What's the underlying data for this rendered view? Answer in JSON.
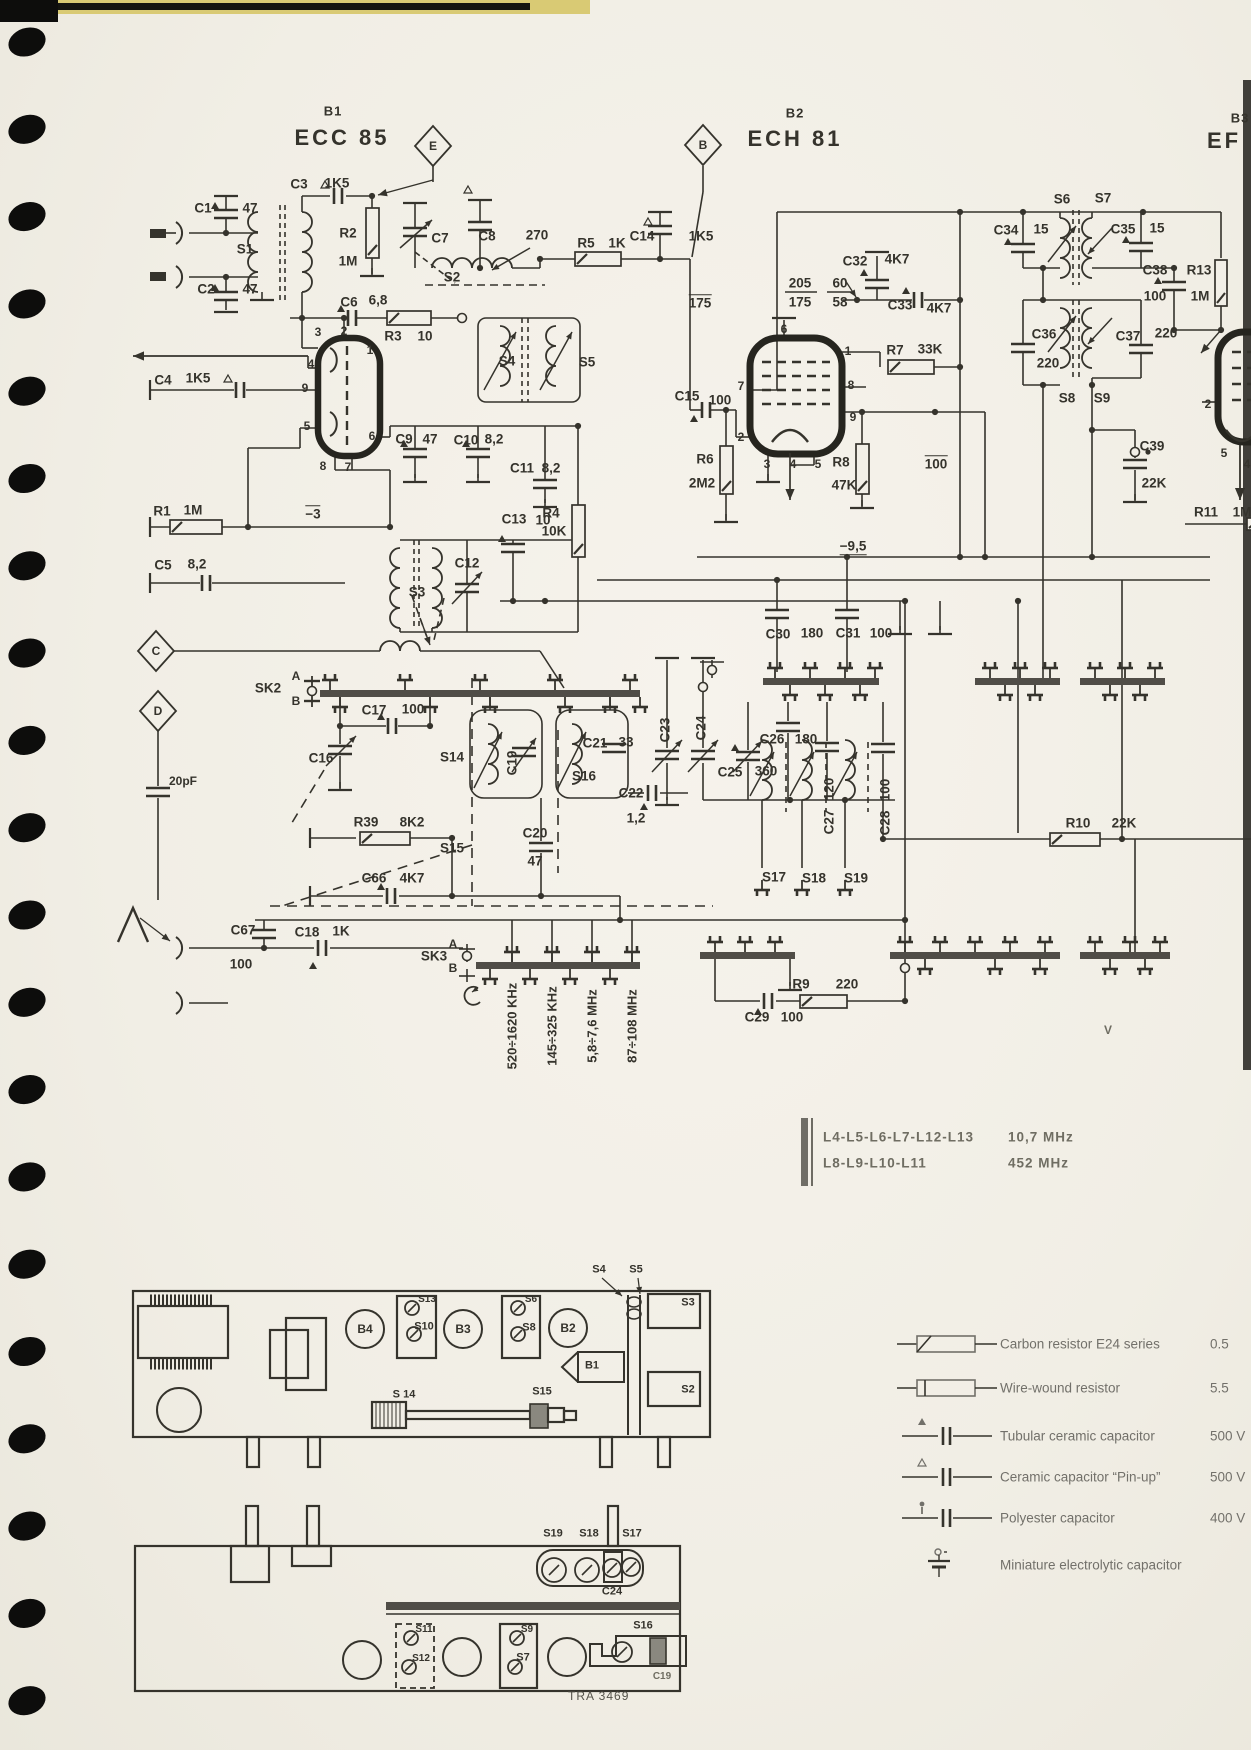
{
  "colors": {
    "paper": "#f2efe7",
    "ink": "#35332c",
    "soft": "#6f6d62",
    "rail": "#504d47",
    "hole": "#0d0d0c",
    "edge": "#413f3a",
    "tape": "#d9ca74"
  },
  "tubes": [
    {
      "ref": "B1",
      "type": "ECC 85"
    },
    {
      "ref": "B2",
      "type": "ECH 81"
    },
    {
      "ref": "B3",
      "type": "EF"
    }
  ],
  "bands": [
    "520÷1620 KHz",
    "145÷325 KHz",
    "5,8÷7,6 MHz",
    "87÷108 MHz"
  ],
  "coil_table": [
    {
      "coils": "L4-L5-L6-L7-L12-L13",
      "freq": "10,7 MHz"
    },
    {
      "coils": "L8-L9-L10-L11",
      "freq": "452 MHz"
    }
  ],
  "legend": [
    {
      "symbol": "carbon-resistor",
      "label": "Carbon resistor E24 series",
      "value": "0.5"
    },
    {
      "symbol": "wire-wound-resistor",
      "label": "Wire-wound resistor",
      "value": "5.5"
    },
    {
      "symbol": "tubular-ceramic-capacitor",
      "label": "Tubular ceramic capacitor",
      "value": "500 V"
    },
    {
      "symbol": "ceramic-capacitor-pinup",
      "label": "Ceramic capacitor “Pin-up”",
      "value": "500 V"
    },
    {
      "symbol": "polyester-capacitor",
      "label": "Polyester capacitor",
      "value": "400 V"
    },
    {
      "symbol": "miniature-electrolytic-capacitor",
      "label": "Miniature electrolytic capacitor",
      "value": ""
    }
  ],
  "footer": {
    "doc_number": "TRA 3469"
  },
  "labels": [
    {
      "n": "tag-e",
      "t": "E",
      "x": 433,
      "y": 146,
      "s": 12
    },
    {
      "n": "tag-b",
      "t": "B",
      "x": 703,
      "y": 145,
      "s": 12
    },
    {
      "n": "tag-c",
      "t": "C",
      "x": 156,
      "y": 651,
      "s": 12
    },
    {
      "n": "tag-d",
      "t": "D",
      "x": 158,
      "y": 711,
      "s": 12
    },
    {
      "n": "c1",
      "t": "C1",
      "x": 203,
      "y": 208
    },
    {
      "n": "c1-v",
      "t": "47",
      "x": 250,
      "y": 208
    },
    {
      "n": "s1",
      "t": "S1",
      "x": 245,
      "y": 249
    },
    {
      "n": "c2",
      "t": "C2",
      "x": 206,
      "y": 289
    },
    {
      "n": "c2-v",
      "t": "47",
      "x": 250,
      "y": 289
    },
    {
      "n": "c3",
      "t": "C3",
      "x": 299,
      "y": 184
    },
    {
      "n": "c3-v",
      "t": "1K5",
      "x": 337,
      "y": 183
    },
    {
      "n": "r2",
      "t": "R2",
      "x": 348,
      "y": 233
    },
    {
      "n": "r2-v",
      "t": "1M",
      "x": 348,
      "y": 261
    },
    {
      "n": "c6",
      "t": "C6",
      "x": 349,
      "y": 302
    },
    {
      "n": "c6-v",
      "t": "6,8",
      "x": 378,
      "y": 300
    },
    {
      "n": "r3",
      "t": "R3",
      "x": 393,
      "y": 336
    },
    {
      "n": "r3-v",
      "t": "10",
      "x": 425,
      "y": 336
    },
    {
      "n": "c7",
      "t": "C7",
      "x": 440,
      "y": 238
    },
    {
      "n": "c8",
      "t": "C8",
      "x": 487,
      "y": 236
    },
    {
      "n": "c8-v",
      "t": "270",
      "x": 537,
      "y": 235
    },
    {
      "n": "s2",
      "t": "S2",
      "x": 452,
      "y": 277
    },
    {
      "n": "r5",
      "t": "R5",
      "x": 586,
      "y": 243
    },
    {
      "n": "r5-v",
      "t": "1K",
      "x": 617,
      "y": 243
    },
    {
      "n": "c14",
      "t": "C14",
      "x": 642,
      "y": 236
    },
    {
      "n": "c14-v",
      "t": "1K5",
      "x": 701,
      "y": 236
    },
    {
      "n": "v175",
      "t": "175",
      "x": 700,
      "y": 302,
      "o": 1
    },
    {
      "n": "v205",
      "t": "205",
      "x": 800,
      "y": 283
    },
    {
      "n": "v175b",
      "t": "175",
      "x": 800,
      "y": 302
    },
    {
      "n": "v60",
      "t": "60",
      "x": 840,
      "y": 283
    },
    {
      "n": "v58",
      "t": "58",
      "x": 840,
      "y": 302
    },
    {
      "n": "c32",
      "t": "C32",
      "x": 855,
      "y": 261
    },
    {
      "n": "c32-v",
      "t": "4K7",
      "x": 897,
      "y": 259
    },
    {
      "n": "c33",
      "t": "C33",
      "x": 900,
      "y": 305
    },
    {
      "n": "c33-v",
      "t": "4K7",
      "x": 939,
      "y": 308
    },
    {
      "n": "r7",
      "t": "R7",
      "x": 895,
      "y": 350
    },
    {
      "n": "r7-v",
      "t": "33K",
      "x": 930,
      "y": 349
    },
    {
      "n": "s6",
      "t": "S6",
      "x": 1062,
      "y": 199
    },
    {
      "n": "s7",
      "t": "S7",
      "x": 1103,
      "y": 198
    },
    {
      "n": "c34",
      "t": "C34",
      "x": 1006,
      "y": 230
    },
    {
      "n": "c34-v",
      "t": "15",
      "x": 1041,
      "y": 229
    },
    {
      "n": "c35",
      "t": "C35",
      "x": 1123,
      "y": 229
    },
    {
      "n": "c35-v",
      "t": "15",
      "x": 1157,
      "y": 228
    },
    {
      "n": "c38",
      "t": "C38",
      "x": 1155,
      "y": 270
    },
    {
      "n": "c38-v",
      "t": "100",
      "x": 1155,
      "y": 296
    },
    {
      "n": "r13",
      "t": "R13",
      "x": 1199,
      "y": 270
    },
    {
      "n": "r13-v",
      "t": "1M",
      "x": 1200,
      "y": 296
    },
    {
      "n": "c36",
      "t": "C36",
      "x": 1044,
      "y": 334
    },
    {
      "n": "c36-v",
      "t": "220",
      "x": 1048,
      "y": 363
    },
    {
      "n": "c37",
      "t": "C37",
      "x": 1128,
      "y": 336
    },
    {
      "n": "c37-v",
      "t": "220",
      "x": 1166,
      "y": 333
    },
    {
      "n": "s8",
      "t": "S8",
      "x": 1067,
      "y": 398
    },
    {
      "n": "s9",
      "t": "S9",
      "x": 1102,
      "y": 398
    },
    {
      "n": "c4",
      "t": "C4",
      "x": 163,
      "y": 380
    },
    {
      "n": "c4-v",
      "t": "1K5",
      "x": 198,
      "y": 378
    },
    {
      "n": "pin-b1-3",
      "t": "3",
      "x": 318,
      "y": 332,
      "s": 12
    },
    {
      "n": "pin-b1-2",
      "t": "2",
      "x": 344,
      "y": 331,
      "s": 12
    },
    {
      "n": "pin-b1-1",
      "t": "1",
      "x": 370,
      "y": 350,
      "s": 12
    },
    {
      "n": "pin-b1-4",
      "t": "4",
      "x": 311,
      "y": 364,
      "s": 12
    },
    {
      "n": "pin-b1-9",
      "t": "9",
      "x": 305,
      "y": 388,
      "s": 12
    },
    {
      "n": "pin-b1-5",
      "t": "5",
      "x": 307,
      "y": 426,
      "s": 12
    },
    {
      "n": "pin-b1-6",
      "t": "6",
      "x": 372,
      "y": 436,
      "s": 12
    },
    {
      "n": "pin-b1-8",
      "t": "8",
      "x": 323,
      "y": 466,
      "s": 12
    },
    {
      "n": "pin-b1-7",
      "t": "7",
      "x": 348,
      "y": 467,
      "s": 12
    },
    {
      "n": "c9",
      "t": "C9",
      "x": 404,
      "y": 439
    },
    {
      "n": "c9-v",
      "t": "47",
      "x": 430,
      "y": 439
    },
    {
      "n": "c10",
      "t": "C10",
      "x": 466,
      "y": 440
    },
    {
      "n": "c10-v",
      "t": "8,2",
      "x": 494,
      "y": 439
    },
    {
      "n": "c11",
      "t": "C11",
      "x": 522,
      "y": 468
    },
    {
      "n": "c11-v",
      "t": "8,2",
      "x": 551,
      "y": 468
    },
    {
      "n": "r1",
      "t": "R1",
      "x": 162,
      "y": 511
    },
    {
      "n": "r1-v",
      "t": "1M",
      "x": 193,
      "y": 510
    },
    {
      "n": "vm3",
      "t": "−3",
      "x": 313,
      "y": 513,
      "o": 1
    },
    {
      "n": "c5",
      "t": "C5",
      "x": 163,
      "y": 565
    },
    {
      "n": "c5-v",
      "t": "8,2",
      "x": 197,
      "y": 564
    },
    {
      "n": "s3",
      "t": "S3",
      "x": 417,
      "y": 592
    },
    {
      "n": "c12",
      "t": "C12",
      "x": 467,
      "y": 563
    },
    {
      "n": "c13",
      "t": "C13",
      "x": 514,
      "y": 519
    },
    {
      "n": "c13-v",
      "t": "10",
      "x": 543,
      "y": 520
    },
    {
      "n": "r4",
      "t": "R4",
      "x": 551,
      "y": 513
    },
    {
      "n": "r4-v",
      "t": "10K",
      "x": 554,
      "y": 531
    },
    {
      "n": "s4",
      "t": "S4",
      "x": 507,
      "y": 361
    },
    {
      "n": "s5",
      "t": "S5",
      "x": 587,
      "y": 362
    },
    {
      "n": "c15",
      "t": "C15",
      "x": 687,
      "y": 396
    },
    {
      "n": "c15-v",
      "t": "100",
      "x": 720,
      "y": 400
    },
    {
      "n": "r6",
      "t": "R6",
      "x": 705,
      "y": 459
    },
    {
      "n": "r6-v",
      "t": "2M2",
      "x": 702,
      "y": 483
    },
    {
      "n": "pin-b2-6",
      "t": "6",
      "x": 784,
      "y": 329,
      "s": 12
    },
    {
      "n": "pin-b2-1",
      "t": "1",
      "x": 848,
      "y": 351,
      "s": 12
    },
    {
      "n": "pin-b2-7",
      "t": "7",
      "x": 741,
      "y": 386,
      "s": 12
    },
    {
      "n": "pin-b2-8",
      "t": "8",
      "x": 851,
      "y": 385,
      "s": 12
    },
    {
      "n": "pin-b2-9",
      "t": "9",
      "x": 853,
      "y": 417,
      "s": 12
    },
    {
      "n": "pin-b2-2",
      "t": "2",
      "x": 741,
      "y": 437,
      "s": 12
    },
    {
      "n": "pin-b2-3",
      "t": "3",
      "x": 767,
      "y": 464,
      "s": 12
    },
    {
      "n": "pin-b2-4",
      "t": "4",
      "x": 793,
      "y": 464,
      "s": 12
    },
    {
      "n": "pin-b2-5",
      "t": "5",
      "x": 818,
      "y": 464,
      "s": 12
    },
    {
      "n": "r8",
      "t": "R8",
      "x": 841,
      "y": 462
    },
    {
      "n": "r8-v",
      "t": "47K",
      "x": 844,
      "y": 485
    },
    {
      "n": "v100",
      "t": "100",
      "x": 936,
      "y": 463,
      "o": 1
    },
    {
      "n": "vm95",
      "t": "−9,5",
      "x": 853,
      "y": 547,
      "u": 1
    },
    {
      "n": "c39",
      "t": "C39",
      "x": 1152,
      "y": 446
    },
    {
      "n": "c39-v",
      "t": "22K",
      "x": 1154,
      "y": 483
    },
    {
      "n": "pin-b3-2",
      "t": "2",
      "x": 1208,
      "y": 404,
      "s": 12
    },
    {
      "n": "pin-b3-5",
      "t": "5",
      "x": 1224,
      "y": 453,
      "s": 12
    },
    {
      "n": "pin-b3-4",
      "t": "4",
      "x": 1247,
      "y": 464,
      "s": 12
    },
    {
      "n": "r11",
      "t": "R11",
      "x": 1206,
      "y": 512
    },
    {
      "n": "r11-v",
      "t": "1M",
      "x": 1242,
      "y": 512
    },
    {
      "n": "c30",
      "t": "C30",
      "x": 778,
      "y": 634
    },
    {
      "n": "c30-v",
      "t": "180",
      "x": 812,
      "y": 633
    },
    {
      "n": "c31",
      "t": "C31",
      "x": 848,
      "y": 633
    },
    {
      "n": "c31-v",
      "t": "100",
      "x": 881,
      "y": 633
    },
    {
      "n": "sk2",
      "t": "SK2",
      "x": 268,
      "y": 688
    },
    {
      "n": "sk2-a",
      "t": "A",
      "x": 296,
      "y": 676,
      "s": 12
    },
    {
      "n": "sk2-b",
      "t": "B",
      "x": 296,
      "y": 701,
      "s": 12
    },
    {
      "n": "c17",
      "t": "C17",
      "x": 374,
      "y": 710
    },
    {
      "n": "c17-v",
      "t": "100",
      "x": 413,
      "y": 709
    },
    {
      "n": "c16",
      "t": "C16",
      "x": 321,
      "y": 758
    },
    {
      "n": "pf20",
      "t": "20pF",
      "x": 183,
      "y": 781,
      "s": 12
    },
    {
      "n": "s14",
      "t": "S14",
      "x": 452,
      "y": 757
    },
    {
      "n": "c19",
      "t": "C19",
      "x": 512,
      "y": 763,
      "r": -90
    },
    {
      "n": "c21",
      "t": "C21",
      "x": 595,
      "y": 743
    },
    {
      "n": "c21-v",
      "t": "33",
      "x": 626,
      "y": 742
    },
    {
      "n": "s16",
      "t": "S16",
      "x": 584,
      "y": 776
    },
    {
      "n": "c23",
      "t": "C23",
      "x": 665,
      "y": 730,
      "r": -90
    },
    {
      "n": "c24",
      "t": "C24",
      "x": 701,
      "y": 728,
      "r": -90
    },
    {
      "n": "c25",
      "t": "C25",
      "x": 730,
      "y": 772
    },
    {
      "n": "c25-v",
      "t": "360",
      "x": 766,
      "y": 771
    },
    {
      "n": "c26",
      "t": "C26",
      "x": 772,
      "y": 739
    },
    {
      "n": "c26-v",
      "t": "180",
      "x": 806,
      "y": 739
    },
    {
      "n": "c22",
      "t": "C22",
      "x": 631,
      "y": 793
    },
    {
      "n": "c22-v",
      "t": "1,2",
      "x": 636,
      "y": 818
    },
    {
      "n": "c27-v",
      "t": "120",
      "x": 829,
      "y": 789,
      "r": -90
    },
    {
      "n": "c27",
      "t": "C27",
      "x": 829,
      "y": 822,
      "r": -90
    },
    {
      "n": "c28-v",
      "t": "100",
      "x": 885,
      "y": 790,
      "r": -90
    },
    {
      "n": "c28",
      "t": "C28",
      "x": 885,
      "y": 823,
      "r": -90
    },
    {
      "n": "r39",
      "t": "R39",
      "x": 366,
      "y": 822
    },
    {
      "n": "r39-v",
      "t": "8K2",
      "x": 412,
      "y": 822
    },
    {
      "n": "s15",
      "t": "S15",
      "x": 452,
      "y": 848
    },
    {
      "n": "c66",
      "t": "C66",
      "x": 374,
      "y": 878
    },
    {
      "n": "c66-v",
      "t": "4K7",
      "x": 412,
      "y": 878
    },
    {
      "n": "c20",
      "t": "C20",
      "x": 535,
      "y": 833
    },
    {
      "n": "c20-v",
      "t": "47",
      "x": 535,
      "y": 861
    },
    {
      "n": "s17",
      "t": "S17",
      "x": 774,
      "y": 877
    },
    {
      "n": "s18",
      "t": "S18",
      "x": 814,
      "y": 878
    },
    {
      "n": "s19",
      "t": "S19",
      "x": 856,
      "y": 878
    },
    {
      "n": "r10",
      "t": "R10",
      "x": 1078,
      "y": 823
    },
    {
      "n": "r10-v",
      "t": "22K",
      "x": 1124,
      "y": 823
    },
    {
      "n": "c67",
      "t": "C67",
      "x": 243,
      "y": 930
    },
    {
      "n": "c67-v",
      "t": "100",
      "x": 241,
      "y": 964
    },
    {
      "n": "c18",
      "t": "C18",
      "x": 307,
      "y": 932
    },
    {
      "n": "c18-v",
      "t": "1K",
      "x": 341,
      "y": 931
    },
    {
      "n": "sk3",
      "t": "SK3",
      "x": 434,
      "y": 956
    },
    {
      "n": "sk3-a",
      "t": "A",
      "x": 453,
      "y": 944,
      "s": 12
    },
    {
      "n": "sk3-b",
      "t": "B",
      "x": 453,
      "y": 968,
      "s": 12
    },
    {
      "n": "r9",
      "t": "R9",
      "x": 801,
      "y": 984
    },
    {
      "n": "r9-v",
      "t": "220",
      "x": 847,
      "y": 984
    },
    {
      "n": "c29",
      "t": "C29",
      "x": 757,
      "y": 1017
    },
    {
      "n": "c29-v",
      "t": "100",
      "x": 792,
      "y": 1017
    },
    {
      "n": "v-right-edge",
      "t": "V",
      "x": 1108,
      "y": 1030,
      "s": 12,
      "c": "#6f6d62"
    },
    {
      "n": "ch-s4",
      "t": "S4",
      "x": 599,
      "y": 1270,
      "s": 11
    },
    {
      "n": "ch-s5",
      "t": "S5",
      "x": 636,
      "y": 1270,
      "s": 11
    },
    {
      "n": "ch-b4",
      "t": "B4",
      "x": 365,
      "y": 1329,
      "s": 12
    },
    {
      "n": "ch-s13",
      "t": "S13",
      "x": 427,
      "y": 1300,
      "s": 10
    },
    {
      "n": "ch-s10",
      "t": "S10",
      "x": 424,
      "y": 1327,
      "s": 11
    },
    {
      "n": "ch-b3",
      "t": "B3",
      "x": 463,
      "y": 1329,
      "s": 12
    },
    {
      "n": "ch-s6",
      "t": "S6",
      "x": 531,
      "y": 1300,
      "s": 10
    },
    {
      "n": "ch-s8",
      "t": "S8",
      "x": 529,
      "y": 1328,
      "s": 11
    },
    {
      "n": "ch-b2",
      "t": "B2",
      "x": 568,
      "y": 1328,
      "s": 12
    },
    {
      "n": "ch-b1",
      "t": "B1",
      "x": 592,
      "y": 1366,
      "s": 11
    },
    {
      "n": "ch-s14",
      "t": "S 14",
      "x": 404,
      "y": 1395,
      "s": 11
    },
    {
      "n": "ch-s15",
      "t": "S15",
      "x": 542,
      "y": 1392,
      "s": 11
    },
    {
      "n": "ch-s3",
      "t": "S3",
      "x": 688,
      "y": 1303,
      "s": 11
    },
    {
      "n": "ch-s2",
      "t": "S2",
      "x": 688,
      "y": 1390,
      "s": 11
    },
    {
      "n": "ch2-s19",
      "t": "S19",
      "x": 553,
      "y": 1534,
      "s": 11
    },
    {
      "n": "ch2-s18",
      "t": "S18",
      "x": 589,
      "y": 1534,
      "s": 11
    },
    {
      "n": "ch2-s17",
      "t": "S17",
      "x": 632,
      "y": 1534,
      "s": 11
    },
    {
      "n": "ch2-c24",
      "t": "C24",
      "x": 612,
      "y": 1592,
      "s": 11
    },
    {
      "n": "ch2-s11",
      "t": "S11",
      "x": 424,
      "y": 1630,
      "s": 10
    },
    {
      "n": "ch2-s12",
      "t": "S12",
      "x": 421,
      "y": 1659,
      "s": 10
    },
    {
      "n": "ch2-s9",
      "t": "S9",
      "x": 527,
      "y": 1630,
      "s": 10
    },
    {
      "n": "ch2-s7",
      "t": "S7",
      "x": 523,
      "y": 1658,
      "s": 11
    },
    {
      "n": "ch2-s16",
      "t": "S16",
      "x": 643,
      "y": 1626,
      "s": 11
    },
    {
      "n": "ch2-c19",
      "t": "C19",
      "x": 662,
      "y": 1677,
      "s": 10,
      "c": "#6f6d62"
    }
  ]
}
